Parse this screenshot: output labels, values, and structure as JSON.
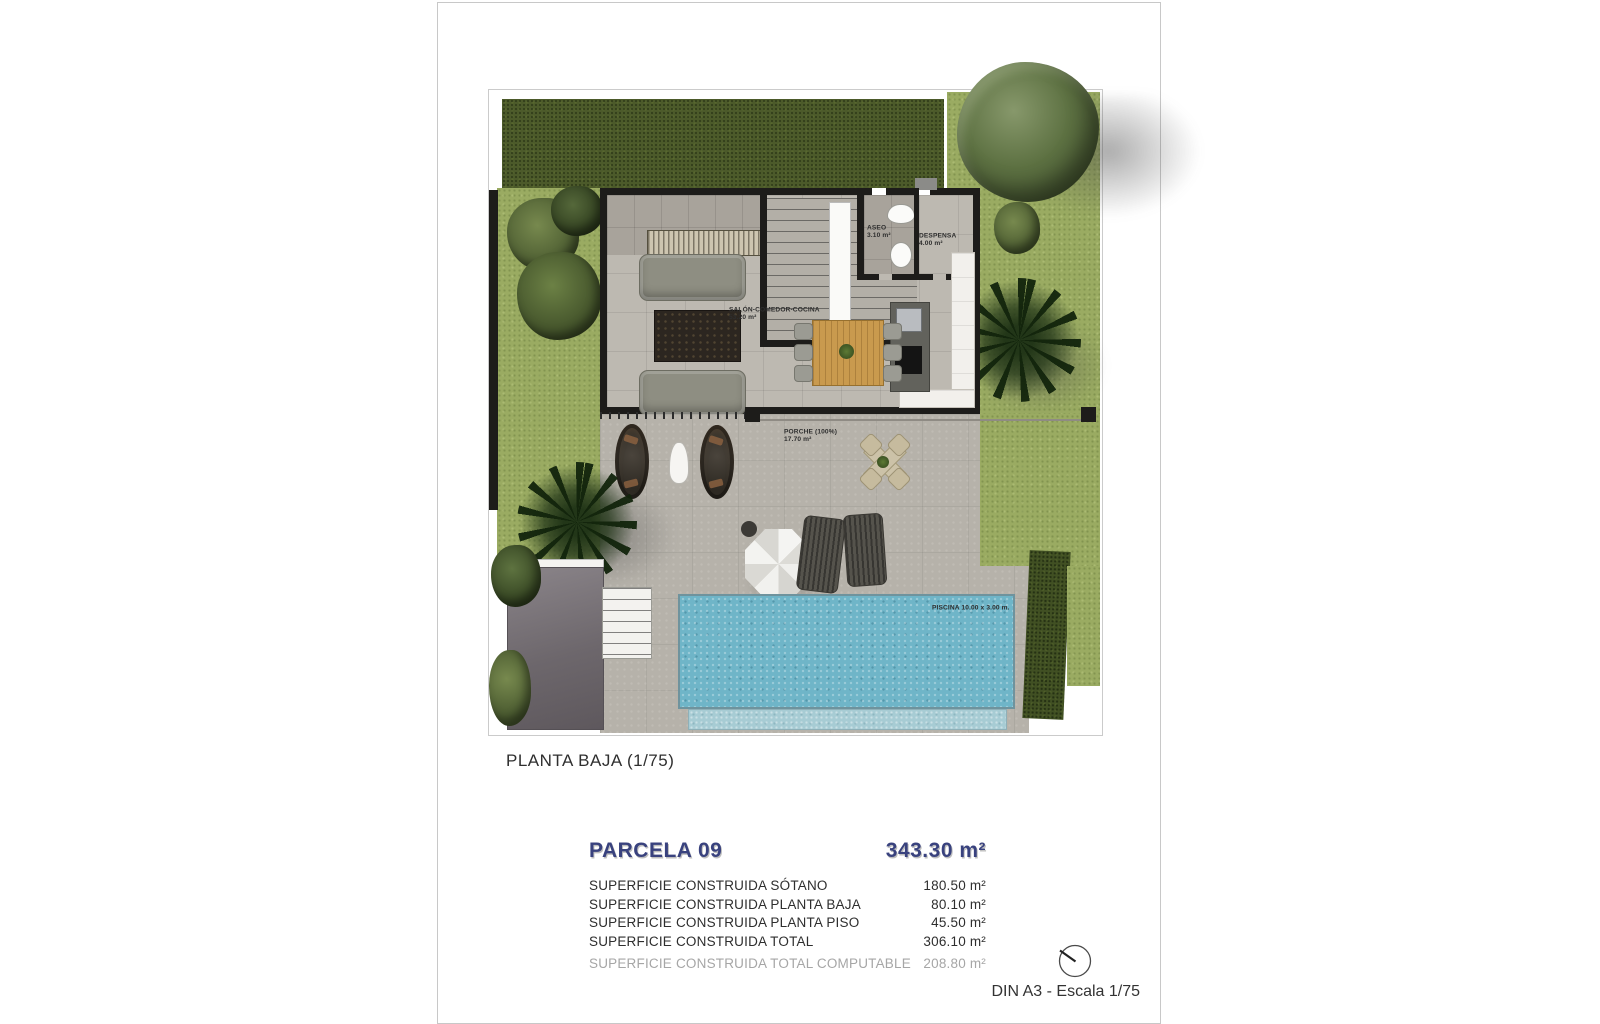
{
  "page": {
    "plan_title": "PLANTA BAJA (1/75)",
    "footer": "DIN A3 - Escala 1/75"
  },
  "plan": {
    "rooms": {
      "salon": {
        "name": "SALÓN-COMEDOR-COCINA",
        "area": "53.20 m²"
      },
      "aseo": {
        "name": "ASEO",
        "area": "3.10 m²"
      },
      "despensa": {
        "name": "DESPENSA",
        "area": "4.00 m²"
      },
      "porche": {
        "name": "PORCHE (100%)",
        "area": "17.70 m²"
      },
      "piscina": {
        "label": "PISCINA 10.00 x 3.00 m."
      }
    }
  },
  "summary": {
    "title": "PARCELA 09",
    "total_area": "343.30 m²",
    "rows": [
      {
        "label": "SUPERFICIE CONSTRUIDA SÓTANO",
        "value": "180.50 m²"
      },
      {
        "label": "SUPERFICIE CONSTRUIDA PLANTA BAJA",
        "value": "80.10 m²"
      },
      {
        "label": "SUPERFICIE CONSTRUIDA PLANTA PISO",
        "value": "45.50 m²"
      },
      {
        "label": "SUPERFICIE CONSTRUIDA TOTAL",
        "value": "306.10 m²"
      },
      {
        "label": "SUPERFICIE CONSTRUIDA TOTAL COMPUTABLE",
        "value": "208.80 m²"
      }
    ]
  },
  "colors": {
    "accent_blue": "#39427e",
    "grass_light": "#9aab62",
    "grass_dark": "#4c5a2a",
    "pool_blue": "#6fb5c8",
    "wall_black": "#1d1c1a"
  }
}
